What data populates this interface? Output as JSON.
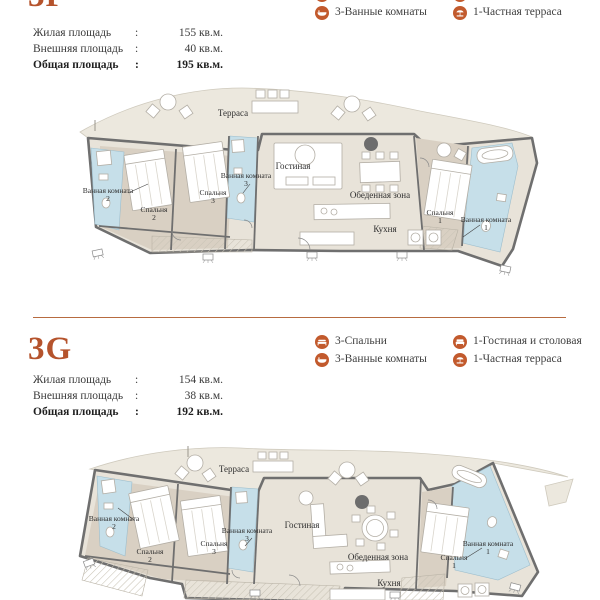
{
  "theme": {
    "accent": "#b5532c",
    "icon_orange": "#c25a2d",
    "divider": "#b76b40",
    "bath_blue": "#c6dfe9",
    "room_tan": "#d9d0c3",
    "floor_light": "#e8e3d9",
    "terrace_fill": "#ece8de",
    "wall_gray": "#6f6f6f"
  },
  "units": [
    {
      "title": "3F",
      "stats": [
        {
          "label": "Жилая площадь",
          "colon": ":",
          "value": "155 кв.м."
        },
        {
          "label": "Внешняя площадь",
          "colon": ":",
          "value": "40 кв.м."
        },
        {
          "label": "Общая площадь",
          "colon": ":",
          "value": "195 кв.м."
        }
      ],
      "legend": [
        {
          "icon": "bed-icon",
          "label": "3-Спальни"
        },
        {
          "icon": "bath-icon",
          "label": "3-Ванные комнаты"
        },
        {
          "icon": "sofa-icon",
          "label": "1-Гостиная и столовая"
        },
        {
          "icon": "parasol-icon",
          "label": "1-Частная терраса"
        }
      ],
      "rooms": {
        "terrace": "Терраса",
        "living": "Гостиная",
        "dining": "Обеденная зона",
        "kitchen": "Кухня",
        "bedroom": "Спальня",
        "bathroom": "Ванная комната",
        "n1": "1",
        "n2": "2",
        "n3": "3"
      }
    },
    {
      "title": "3G",
      "stats": [
        {
          "label": "Жилая площадь",
          "colon": ":",
          "value": "154 кв.м."
        },
        {
          "label": "Внешняя площадь",
          "colon": ":",
          "value": "38 кв.м."
        },
        {
          "label": "Общая площадь",
          "colon": ":",
          "value": "192 кв.м."
        }
      ],
      "legend": [
        {
          "icon": "bed-icon",
          "label": "3-Спальни"
        },
        {
          "icon": "bath-icon",
          "label": "3-Ванные комнаты"
        },
        {
          "icon": "sofa-icon",
          "label": "1-Гостиная и столовая"
        },
        {
          "icon": "parasol-icon",
          "label": "1-Частная терраса"
        }
      ],
      "rooms": {
        "terrace": "Терраса",
        "living": "Гостиная",
        "dining": "Обеденная зона",
        "kitchen": "Кухня",
        "bedroom": "Спальня",
        "bathroom": "Ванная комната",
        "n1": "1",
        "n2": "2",
        "n3": "3"
      }
    }
  ]
}
